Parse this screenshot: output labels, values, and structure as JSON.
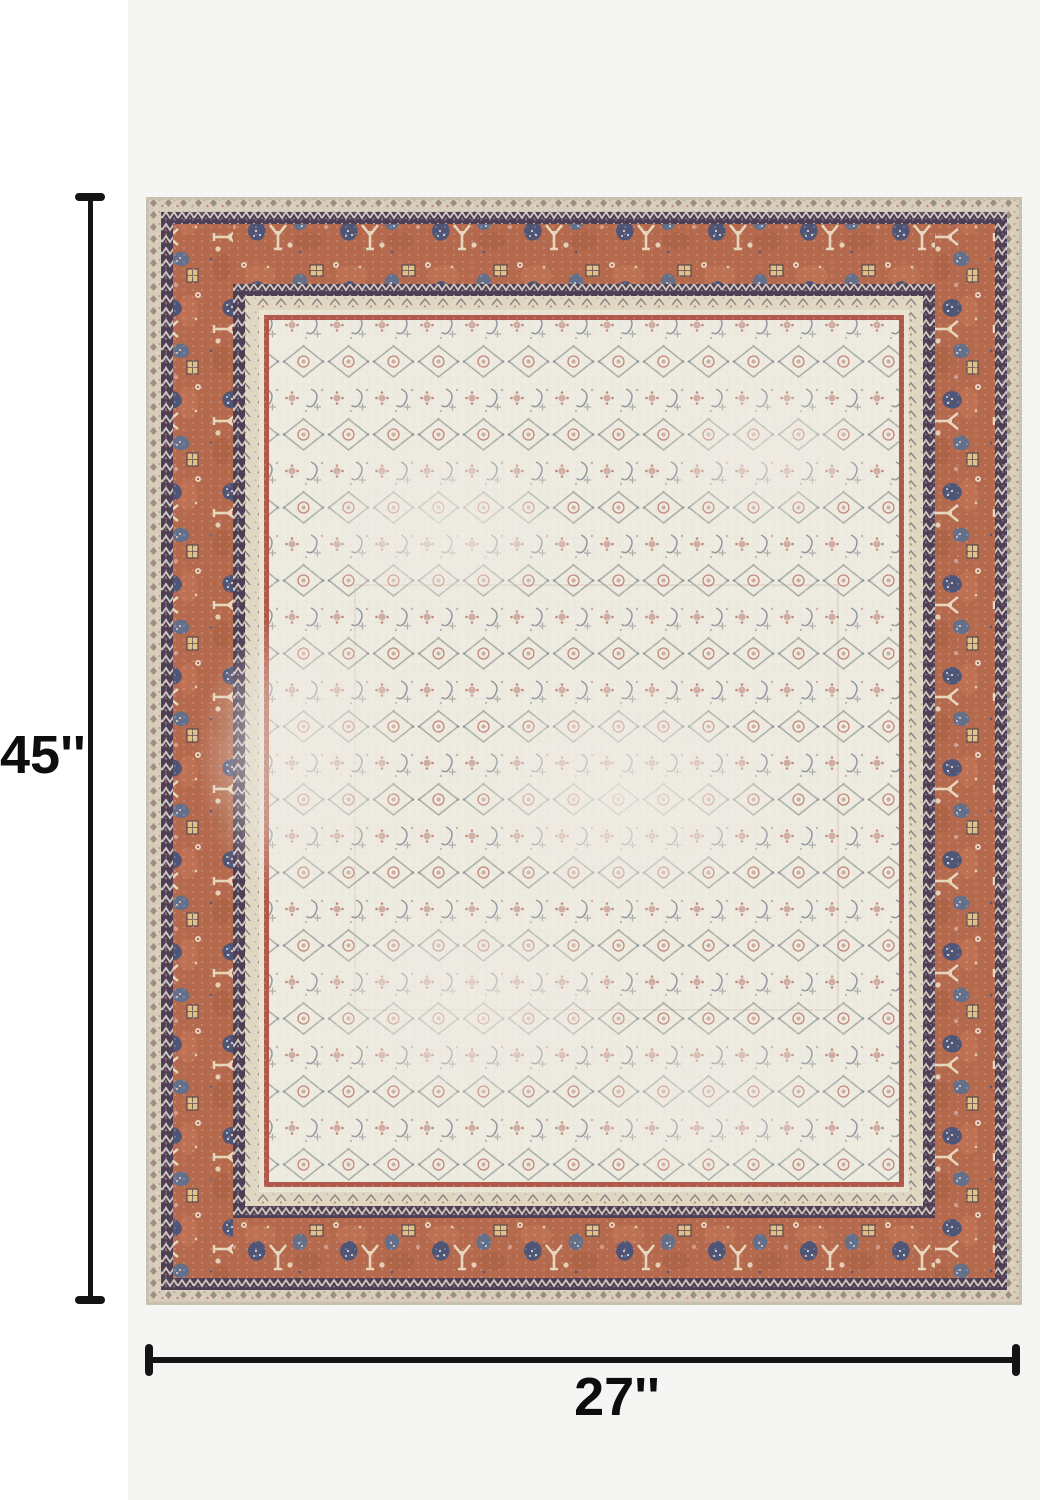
{
  "page": {
    "kind": "rug product dimension image",
    "background_color": "#ffffff",
    "photo_background_color": "#f5f5f3",
    "annotation_color": "#141414"
  },
  "dimension_annotations": {
    "height": {
      "label": "45''",
      "orientation": "vertical"
    },
    "width": {
      "label": "27''",
      "orientation": "horizontal"
    }
  },
  "rug": {
    "style": "distressed vintage oriental area rug",
    "edge_color": "#c9bfae",
    "outer_band_color": "#d8cdbb",
    "guard_dark_color": "#4e3f54",
    "border_terracotta": "#b5694d",
    "accent_navy": "#4a5478",
    "accent_cream": "#e9dcc2",
    "accent_yellow": "#e2c084",
    "inner_band_color": "#e0d6c2",
    "gap_band_color": "#e9e3d4",
    "rust_line_color": "#b0584a",
    "field_ivory": "#edeae0",
    "field_motif_rust": "#c18f82",
    "field_motif_gray": "#8d948e",
    "field_motif_blue": "#667082"
  }
}
